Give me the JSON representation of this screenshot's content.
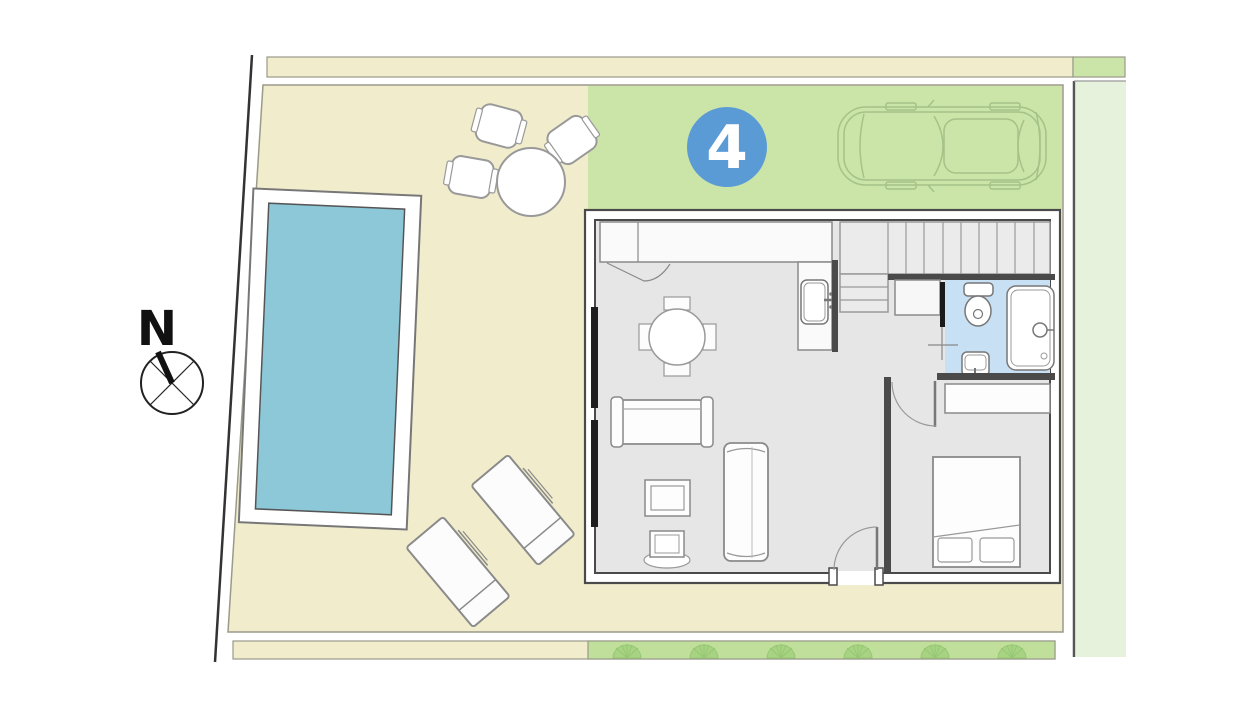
{
  "plan": {
    "title": "villa-floor-plan",
    "unit_badge": {
      "number": "4",
      "bg_color": "#5B9BD5",
      "text_color": "#FFFFFF"
    },
    "compass": {
      "label": "N"
    },
    "colors": {
      "yard": "#F1EDCC",
      "driveway_green": "#CBE4A8",
      "neighbor_green": "#E6F2DC",
      "strip_green": "#BFDF9B",
      "fan_green": "#A8D383",
      "pool_water": "#8CC8D8",
      "pool_deck": "#FFFFFF",
      "floor_gray": "#E6E6E6",
      "bath_floor_blue": "#C8E0F4",
      "wall_dark": "#4A4A4A",
      "line_gray": "#8A8A8A",
      "car_line_green": "#A5C289"
    },
    "elements": [
      "plot-boundary",
      "top-landscaping-strip",
      "main-yard",
      "driveway",
      "neighbor-plot-strip",
      "bottom-landscaping-strip",
      "swimming-pool",
      "compass-rose",
      "outdoor-table-set",
      "sun-loungers",
      "car-icon",
      "unit-number-badge",
      "house-walls",
      "kitchen-counter",
      "kitchen-sink",
      "staircase",
      "bathroom",
      "toilet",
      "bathtub",
      "bathroom-sink",
      "bedroom",
      "bed",
      "wardrobe",
      "sofa",
      "chaise",
      "coffee-table",
      "tv-unit",
      "dining-table",
      "entrance-door",
      "bedroom-door",
      "sliding-door"
    ]
  }
}
